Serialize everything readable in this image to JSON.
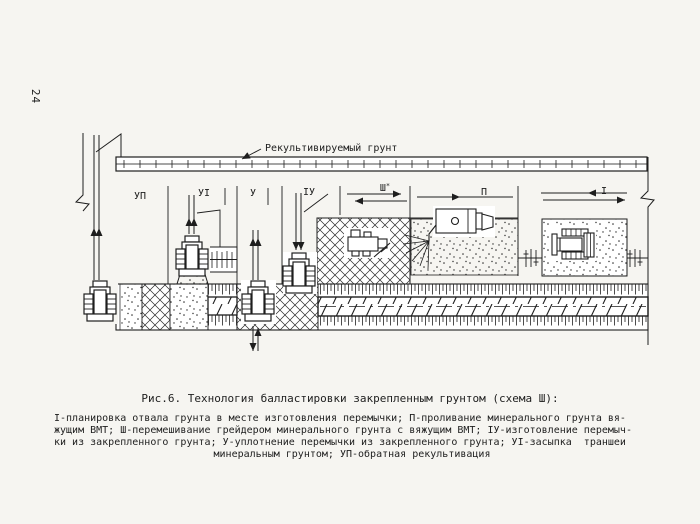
{
  "page": {
    "number": "24"
  },
  "diagram": {
    "top_label": "Рекультивируемый грунт",
    "stages": [
      {
        "label": "УП"
      },
      {
        "label": "УI"
      },
      {
        "label": "У"
      },
      {
        "label": "IУ"
      },
      {
        "label": "Ш",
        "mark": "*"
      },
      {
        "label": "П"
      },
      {
        "label": "I"
      }
    ]
  },
  "caption": {
    "title": "Рис.6. Технология балластировки закрепленным грунтом (схема Ш):",
    "legend_lines": [
      "I-планировка отвала грунта в месте изготовления перемычки; П-проливание минерального грунта вя-",
      "жущим ВМТ; Ш-перемешивание грейдером минерального грунта с вяжущим ВМТ; IУ-изготовление перемыч-",
      "ки из закрепленного грунта; У-уплотнение перемычки из закрепленного грунта; УI-засыпка  траншеи",
      "минеральным грунтом; УП-обратная рекультивация"
    ]
  },
  "colors": {
    "ink": "#1e1e1e",
    "paper": "#f6f5f1"
  }
}
